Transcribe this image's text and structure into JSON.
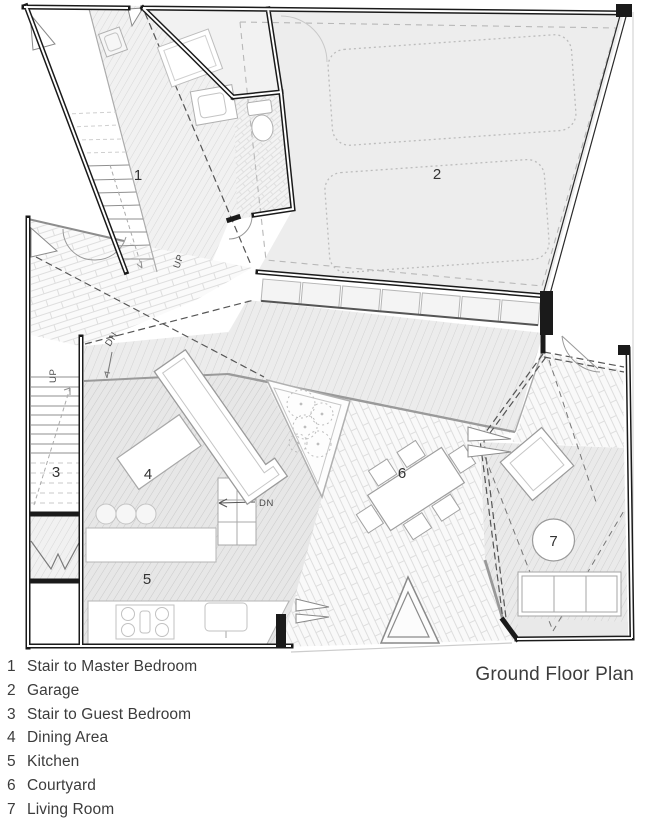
{
  "title": "Ground Floor Plan",
  "legend": {
    "items": [
      {
        "number": "1",
        "label": "Stair to Master Bedroom"
      },
      {
        "number": "2",
        "label": "Garage"
      },
      {
        "number": "3",
        "label": "Stair to Guest Bedroom"
      },
      {
        "number": "4",
        "label": "Dining Area"
      },
      {
        "number": "5",
        "label": "Kitchen"
      },
      {
        "number": "6",
        "label": "Courtyard"
      },
      {
        "number": "7",
        "label": "Living Room"
      }
    ]
  },
  "plan": {
    "annotations": {
      "up": "UP",
      "dn": "DN"
    },
    "colors": {
      "wall": "#1a1a1a",
      "garage_floor": "#ededed",
      "dining_floor": "#e7e7e7",
      "hatch_line": "#d4d4d4",
      "brick_line": "#dedede",
      "dashed_line": "#555555",
      "furniture_outline": "#9a9a9a",
      "text": "#3a3a3a"
    }
  }
}
